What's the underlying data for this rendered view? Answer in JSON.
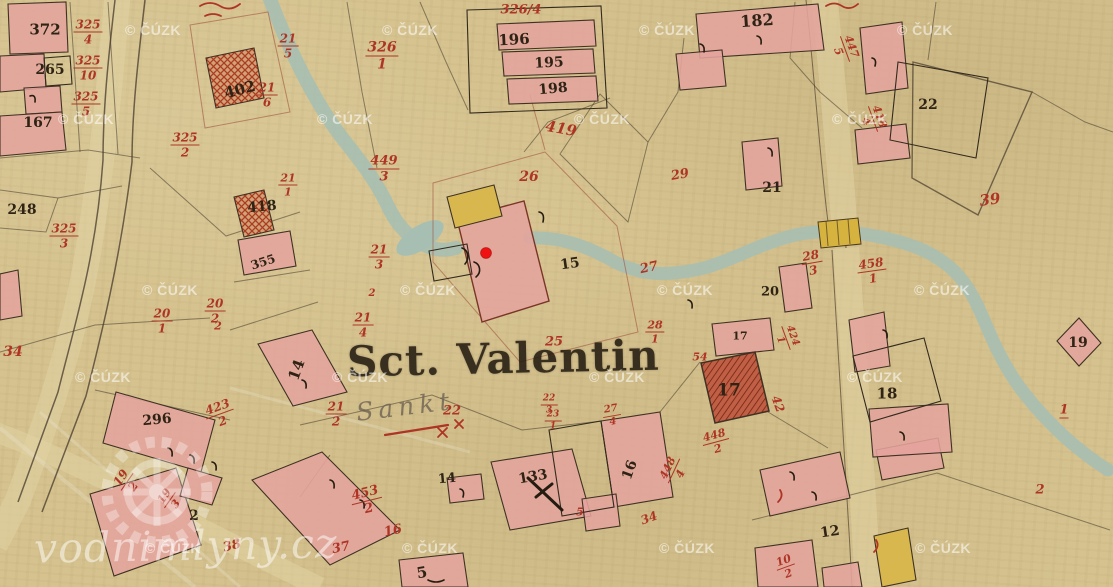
{
  "map": {
    "place_name": "Sct. Valentin",
    "place_name_script": "Sankt",
    "copyright_watermark": "© ČÚZK",
    "site_watermark": "vodnimlyny.cz",
    "marker": {
      "x": 486,
      "y": 253,
      "color": "#f01212"
    },
    "colors": {
      "paper": "#d5c28e",
      "building_masonry": "#e4a49d",
      "building_wood": "#d8b84e",
      "stream": "#a7bfb2",
      "parcel_number_red": "#ae3526",
      "house_number_black": "#2e2315"
    },
    "watermark_positions": [
      [
        153,
        30
      ],
      [
        410,
        30
      ],
      [
        667,
        30
      ],
      [
        925,
        30
      ],
      [
        86,
        119
      ],
      [
        345,
        119
      ],
      [
        602,
        119
      ],
      [
        860,
        119
      ],
      [
        170,
        290
      ],
      [
        428,
        290
      ],
      [
        685,
        290
      ],
      [
        942,
        290
      ],
      [
        103,
        377
      ],
      [
        360,
        377
      ],
      [
        617,
        377
      ],
      [
        875,
        377
      ],
      [
        173,
        548
      ],
      [
        430,
        548
      ],
      [
        687,
        548
      ],
      [
        943,
        548
      ]
    ],
    "labels": [
      {
        "t": "372",
        "c": "k",
        "x": 45,
        "y": 30,
        "s": 15
      },
      {
        "t": "265",
        "c": "k",
        "x": 50,
        "y": 70,
        "s": 14
      },
      {
        "t": "167",
        "c": "k",
        "x": 38,
        "y": 123,
        "s": 14
      },
      {
        "t": "325",
        "b": "4",
        "c": "r",
        "x": 88,
        "y": 32,
        "s": 12
      },
      {
        "t": "325",
        "b": "10",
        "c": "r",
        "x": 88,
        "y": 68,
        "s": 12
      },
      {
        "t": "325",
        "b": "5",
        "c": "r",
        "x": 86,
        "y": 104,
        "s": 12
      },
      {
        "t": "325",
        "b": "2",
        "c": "r",
        "x": 185,
        "y": 145,
        "s": 12
      },
      {
        "t": "325",
        "b": "3",
        "c": "r",
        "x": 64,
        "y": 236,
        "s": 12
      },
      {
        "t": "402",
        "c": "k",
        "x": 240,
        "y": 90,
        "s": 15,
        "r": -15
      },
      {
        "t": "21",
        "b": "6",
        "c": "r",
        "x": 267,
        "y": 95,
        "s": 12
      },
      {
        "t": "21",
        "b": "5",
        "c": "r",
        "x": 288,
        "y": 46,
        "s": 12
      },
      {
        "t": "248",
        "c": "k",
        "x": 22,
        "y": 210,
        "s": 14
      },
      {
        "t": "326",
        "b": "1",
        "c": "r",
        "x": 382,
        "y": 56,
        "s": 14
      },
      {
        "t": "326/4",
        "c": "r",
        "x": 521,
        "y": 10,
        "s": 13
      },
      {
        "t": "196",
        "c": "k",
        "x": 514,
        "y": 40,
        "s": 15,
        "r": -3
      },
      {
        "t": "195",
        "c": "k",
        "x": 549,
        "y": 63,
        "s": 14,
        "r": -3
      },
      {
        "t": "198",
        "c": "k",
        "x": 553,
        "y": 89,
        "s": 14,
        "r": -5
      },
      {
        "t": "419",
        "c": "r",
        "x": 561,
        "y": 129,
        "s": 15,
        "r": 10
      },
      {
        "t": "449",
        "b": "3",
        "c": "r",
        "x": 384,
        "y": 169,
        "s": 13
      },
      {
        "t": "26",
        "c": "r",
        "x": 529,
        "y": 177,
        "s": 14
      },
      {
        "t": "182",
        "c": "k",
        "x": 757,
        "y": 21,
        "s": 16,
        "r": -4
      },
      {
        "t": "447",
        "b": "5",
        "c": "r",
        "x": 845,
        "y": 49,
        "s": 11,
        "r": 70
      },
      {
        "t": "418",
        "b": "4",
        "c": "r",
        "x": 873,
        "y": 119,
        "s": 11,
        "r": 70
      },
      {
        "t": "22",
        "c": "k",
        "x": 928,
        "y": 105,
        "s": 14
      },
      {
        "t": "39",
        "c": "r",
        "x": 990,
        "y": 200,
        "s": 15,
        "r": -8
      },
      {
        "t": "29",
        "c": "r",
        "x": 680,
        "y": 175,
        "s": 13,
        "r": -10
      },
      {
        "t": "21",
        "c": "k",
        "x": 772,
        "y": 188,
        "s": 14
      },
      {
        "t": "21",
        "b": "1",
        "c": "r",
        "x": 288,
        "y": 185,
        "s": 11
      },
      {
        "t": "418",
        "c": "k",
        "x": 262,
        "y": 207,
        "s": 14,
        "r": -5
      },
      {
        "t": "355",
        "c": "k",
        "x": 263,
        "y": 262,
        "s": 12,
        "r": -18
      },
      {
        "t": "20",
        "b": "2",
        "c": "r",
        "x": 215,
        "y": 311,
        "s": 12
      },
      {
        "t": "20",
        "b": "1",
        "c": "r",
        "x": 162,
        "y": 321,
        "s": 12
      },
      {
        "t": "21",
        "b": "3",
        "c": "r",
        "x": 379,
        "y": 257,
        "s": 12
      },
      {
        "t": "2",
        "c": "r",
        "x": 372,
        "y": 294,
        "s": 10
      },
      {
        "t": "21",
        "b": "4",
        "c": "r",
        "x": 363,
        "y": 325,
        "s": 12
      },
      {
        "t": "21",
        "b": "2",
        "c": "r",
        "x": 336,
        "y": 414,
        "s": 12
      },
      {
        "t": "14",
        "c": "k",
        "x": 297,
        "y": 370,
        "s": 15,
        "r": -70
      },
      {
        "t": "15",
        "c": "k",
        "x": 570,
        "y": 264,
        "s": 14,
        "r": -8
      },
      {
        "t": "25",
        "c": "r",
        "x": 554,
        "y": 342,
        "s": 13
      },
      {
        "t": "27",
        "c": "r",
        "x": 649,
        "y": 268,
        "s": 13,
        "r": -12
      },
      {
        "t": "28",
        "b": "1",
        "c": "r",
        "x": 655,
        "y": 332,
        "s": 11
      },
      {
        "t": "28",
        "b": "3",
        "c": "r",
        "x": 812,
        "y": 263,
        "s": 12,
        "r": -10
      },
      {
        "t": "458",
        "b": "1",
        "c": "r",
        "x": 872,
        "y": 271,
        "s": 12,
        "r": -8
      },
      {
        "t": "20",
        "c": "k",
        "x": 770,
        "y": 292,
        "s": 13
      },
      {
        "t": "17",
        "c": "k",
        "x": 740,
        "y": 336,
        "s": 11
      },
      {
        "t": "424",
        "b": "1",
        "c": "r",
        "x": 786,
        "y": 338,
        "s": 10,
        "r": 70
      },
      {
        "t": "54",
        "c": "r",
        "x": 700,
        "y": 357,
        "s": 11
      },
      {
        "t": "17",
        "c": "k",
        "x": 729,
        "y": 391,
        "s": 17
      },
      {
        "t": "42",
        "c": "r",
        "x": 778,
        "y": 404,
        "s": 12,
        "r": 70
      },
      {
        "t": "448",
        "b": "2",
        "c": "r",
        "x": 716,
        "y": 442,
        "s": 11,
        "r": -15
      },
      {
        "t": "448",
        "b": "4",
        "c": "r",
        "x": 674,
        "y": 471,
        "s": 11,
        "r": -65
      },
      {
        "t": "16",
        "c": "k",
        "x": 630,
        "y": 470,
        "s": 14,
        "r": -70
      },
      {
        "t": "34",
        "c": "r",
        "x": 649,
        "y": 518,
        "s": 12,
        "r": -20
      },
      {
        "t": "18",
        "c": "k",
        "x": 887,
        "y": 394,
        "s": 15
      },
      {
        "t": "19",
        "c": "k",
        "x": 1078,
        "y": 343,
        "s": 14
      },
      {
        "t": "1",
        "c": "r",
        "x": 1064,
        "y": 411,
        "s": 13,
        "u": 1
      },
      {
        "t": "2",
        "c": "r",
        "x": 1040,
        "y": 490,
        "s": 13
      },
      {
        "t": "19",
        "b": "2",
        "c": "r",
        "x": 127,
        "y": 482,
        "s": 12,
        "r": -55
      },
      {
        "t": "19",
        "b": "3",
        "c": "r",
        "x": 170,
        "y": 500,
        "s": 11,
        "r": -55
      },
      {
        "t": "2",
        "c": "k",
        "x": 194,
        "y": 516,
        "s": 14
      },
      {
        "t": "38",
        "c": "r",
        "x": 232,
        "y": 546,
        "s": 13,
        "r": -15
      },
      {
        "t": "296",
        "c": "k",
        "x": 157,
        "y": 420,
        "s": 14,
        "r": -5
      },
      {
        "t": "423",
        "b": "2",
        "c": "r",
        "x": 220,
        "y": 414,
        "s": 12,
        "r": -20
      },
      {
        "t": "34",
        "c": "r",
        "x": 13,
        "y": 352,
        "s": 14
      },
      {
        "t": "2",
        "c": "r",
        "x": 218,
        "y": 326,
        "s": 11
      },
      {
        "t": "453",
        "b": "2",
        "c": "r",
        "x": 367,
        "y": 501,
        "s": 13,
        "r": -14
      },
      {
        "t": "14",
        "c": "k",
        "x": 447,
        "y": 479,
        "s": 13,
        "r": -5
      },
      {
        "t": "133",
        "c": "k",
        "x": 533,
        "y": 477,
        "s": 14,
        "r": -10
      },
      {
        "t": "5",
        "c": "r",
        "x": 580,
        "y": 512,
        "s": 11
      },
      {
        "t": "16",
        "c": "r",
        "x": 393,
        "y": 531,
        "s": 13,
        "r": -12
      },
      {
        "t": "37",
        "c": "r",
        "x": 341,
        "y": 548,
        "s": 13,
        "r": -12
      },
      {
        "t": "5",
        "c": "k",
        "x": 422,
        "y": 573,
        "s": 15,
        "r": -10
      },
      {
        "t": "12",
        "c": "k",
        "x": 830,
        "y": 532,
        "s": 14,
        "r": -8
      },
      {
        "t": "10",
        "b": "2",
        "c": "r",
        "x": 786,
        "y": 567,
        "s": 11,
        "r": -20
      },
      {
        "t": "22",
        "c": "r",
        "x": 452,
        "y": 411,
        "s": 13
      },
      {
        "t": "22",
        "b": "3",
        "c": "r",
        "x": 549,
        "y": 405,
        "s": 9
      },
      {
        "t": "23",
        "b": "1",
        "c": "r",
        "x": 553,
        "y": 421,
        "s": 9
      },
      {
        "t": "27",
        "b": "4",
        "c": "r",
        "x": 612,
        "y": 416,
        "s": 10,
        "r": -10
      }
    ]
  }
}
